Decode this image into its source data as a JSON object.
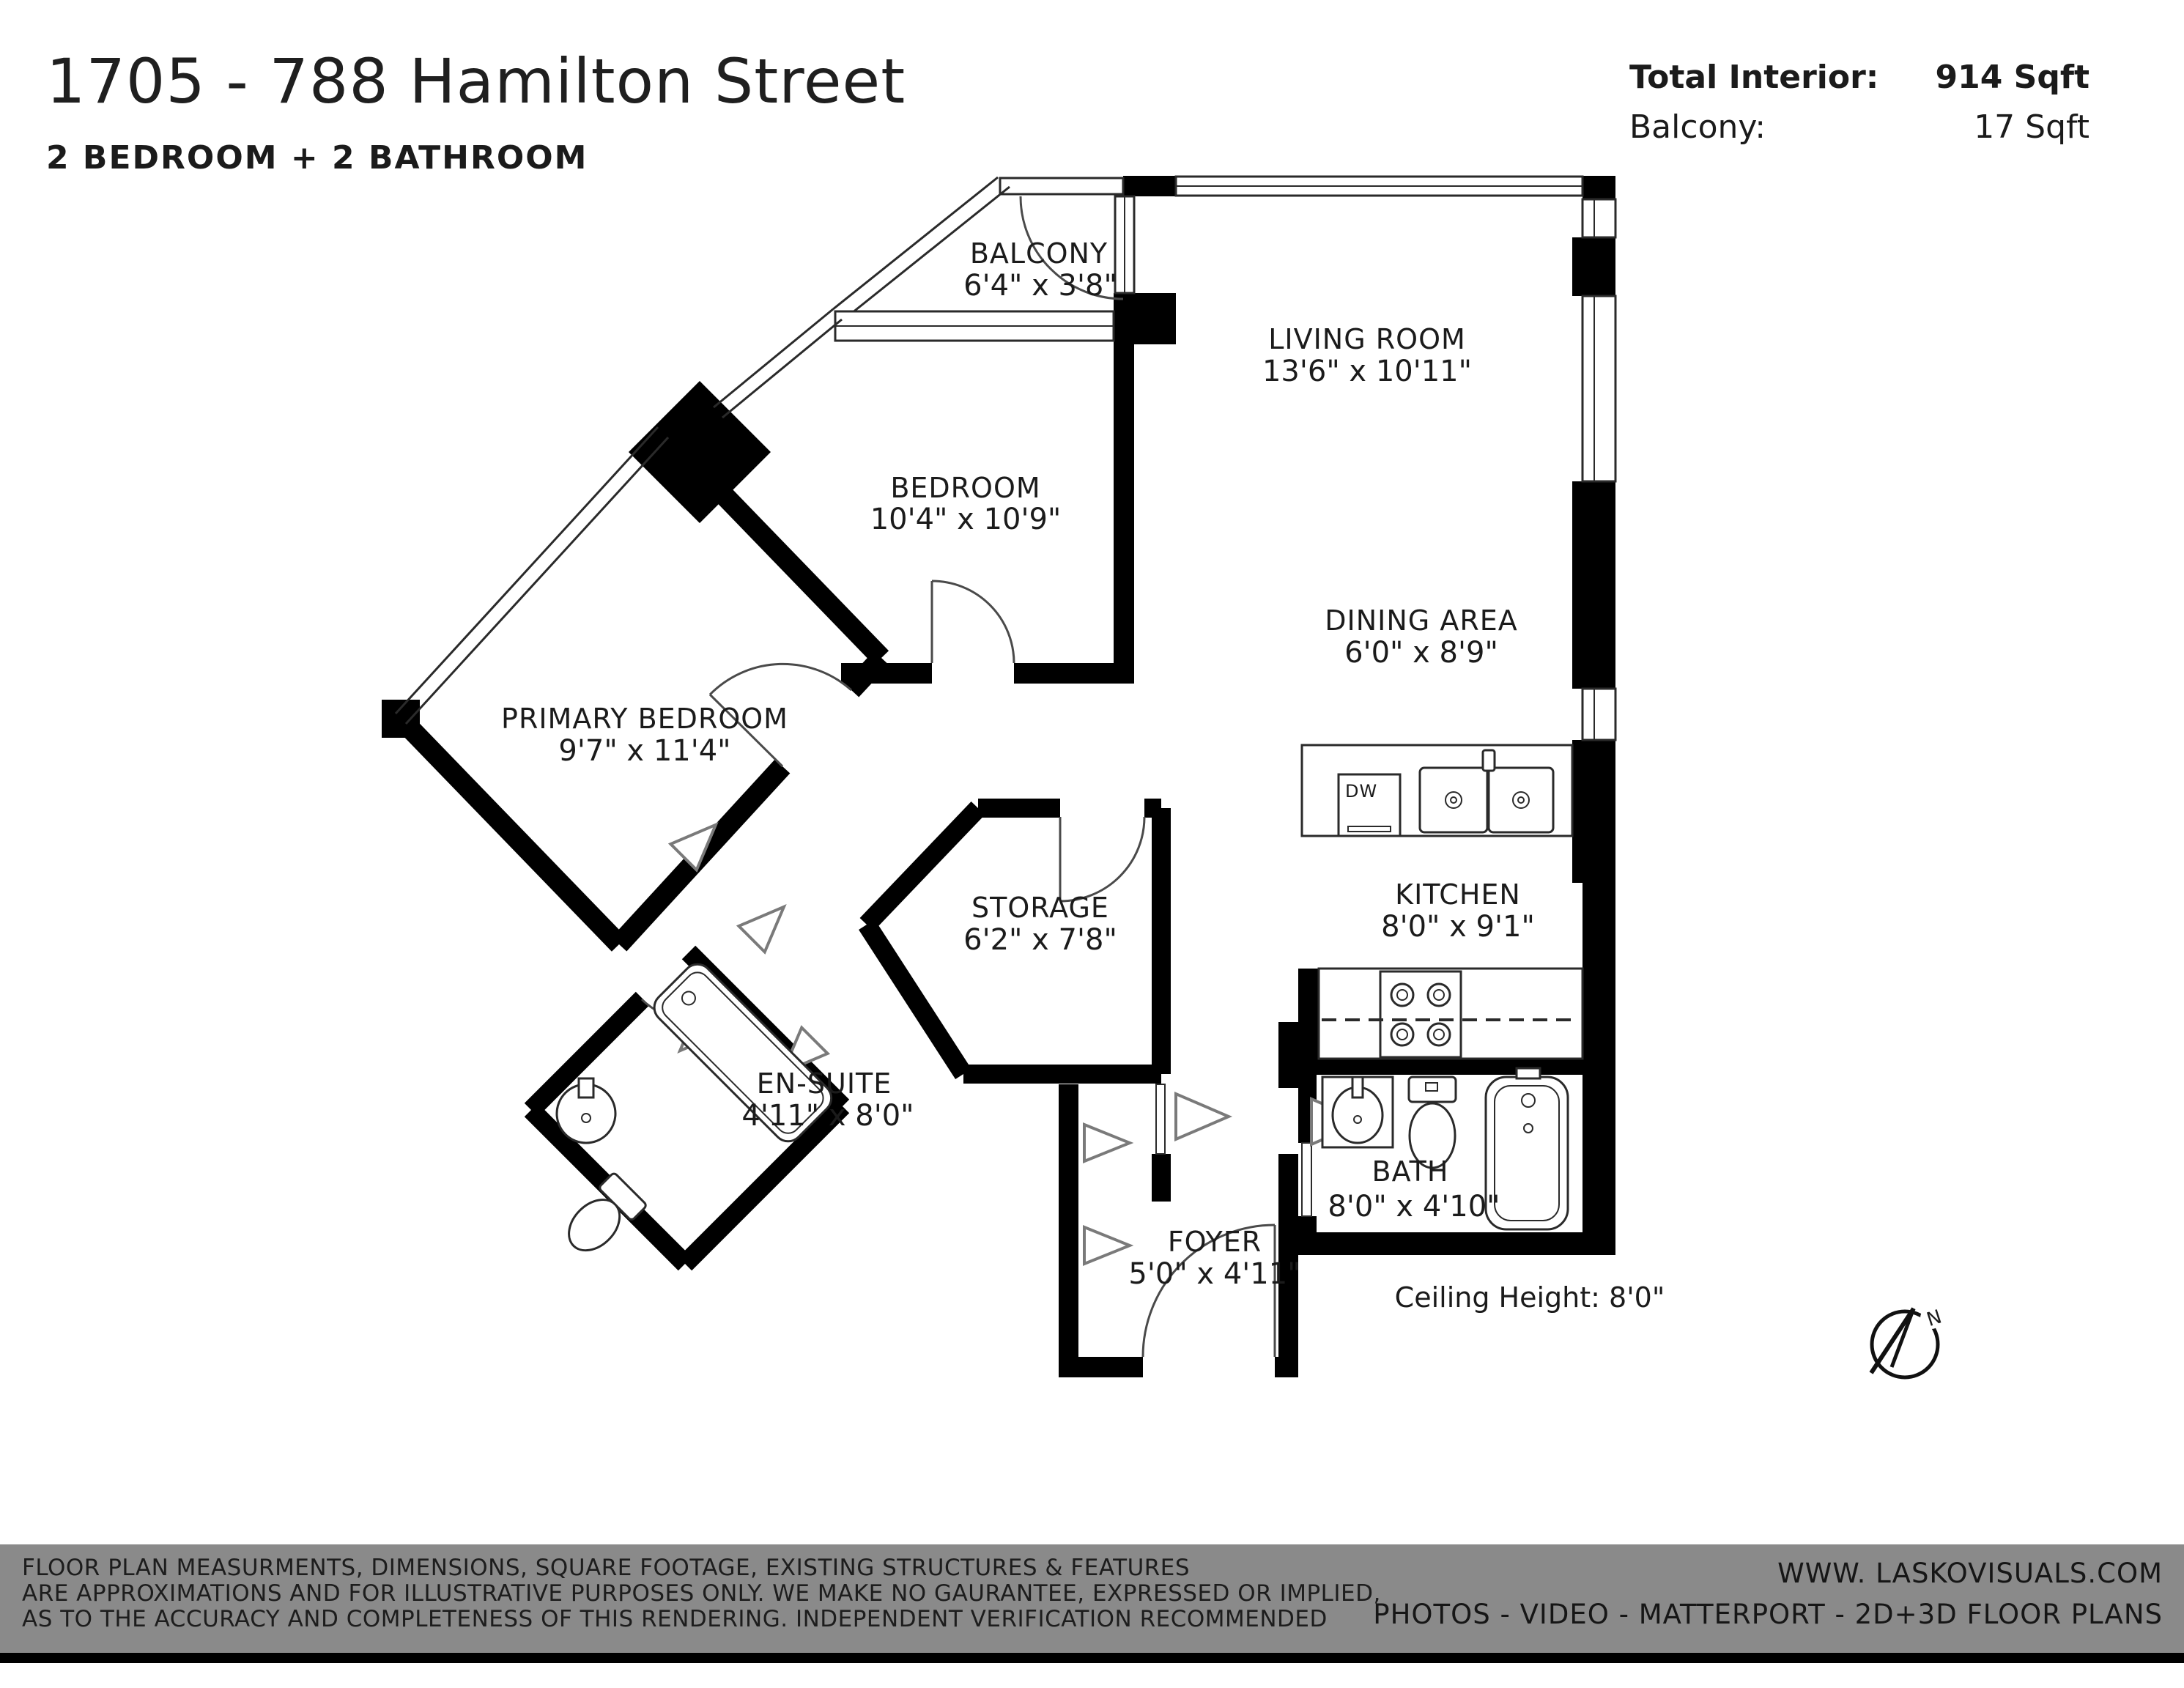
{
  "header": {
    "title": "1705 - 788 Hamilton Street",
    "subtitle": "2 BEDROOM + 2 BATHROOM",
    "total_interior_label": "Total Interior:",
    "total_interior_value": "914 Sqft",
    "balcony_label": "Balcony:",
    "balcony_value": "17 Sqft"
  },
  "rooms": [
    {
      "name": "BALCONY",
      "dims": "6'4\" x 3'8\""
    },
    {
      "name": "LIVING ROOM",
      "dims": "13'6\" x 10'11\""
    },
    {
      "name": "BEDROOM",
      "dims": "10'4\" x 10'9\""
    },
    {
      "name": "DINING AREA",
      "dims": "6'0\" x 8'9\""
    },
    {
      "name": "PRIMARY BEDROOM",
      "dims": "9'7\" x 11'4\""
    },
    {
      "name": "STORAGE",
      "dims": "6'2\" x 7'8\""
    },
    {
      "name": "KITCHEN",
      "dims": "8'0\" x 9'1\""
    },
    {
      "name": "EN-SUITE",
      "dims": "4'11\" x 8'0\""
    },
    {
      "name": "FOYER",
      "dims": "5'0\" x 4'11\""
    },
    {
      "name": "BATH",
      "dims": "8'0\" x 4'10\""
    }
  ],
  "plan_notes": {
    "ceiling_height": "Ceiling Height: 8'0\"",
    "dishwasher": "DW",
    "compass_north": "N"
  },
  "footer": {
    "disclaimer_line1": "FLOOR PLAN MEASURMENTS, DIMENSIONS, SQUARE FOOTAGE, EXISTING STRUCTURES & FEATURES",
    "disclaimer_line2": "ARE APPROXIMATIONS AND FOR ILLUSTRATIVE PURPOSES ONLY.  WE MAKE NO GAURANTEE, EXPRESSED OR IMPLIED,",
    "disclaimer_line3": "AS TO THE ACCURACY AND COMPLETENESS OF THIS RENDERING. INDEPENDENT VERIFICATION RECOMMENDED",
    "website": "WWW. LASKOVISUALS.COM",
    "services": "PHOTOS - VIDEO - MATTERPORT - 2D+3D FLOOR PLANS"
  },
  "colors": {
    "wall": "#000000",
    "footer_bg": "#8a8a8a",
    "footer_strip": "#000000",
    "text": "#1b1b1b"
  }
}
